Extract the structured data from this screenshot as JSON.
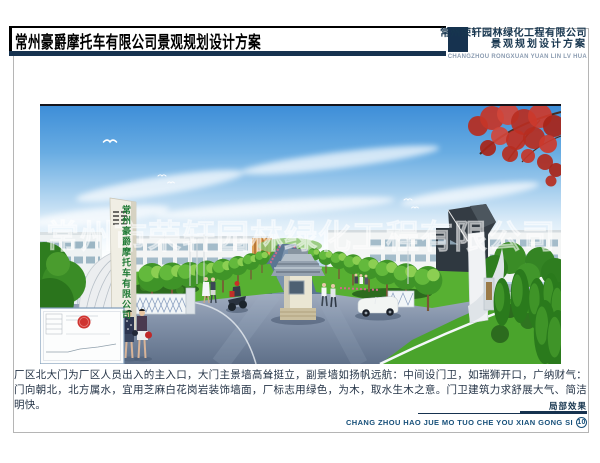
{
  "header": {
    "title": "常州豪爵摩托车有限公司景观规划设计方案",
    "company_name": "常州荣轩园林绿化工程有限公司",
    "company_subtitle": "景观规划设计方案",
    "company_pinyin": "CHANGZHOU RONGXUAN YUAN LIN LV HUA"
  },
  "photo": {
    "watermark": "常州市荣轩园林绿化工程有限公司",
    "gate_sign_text": "常州豪爵摩托车有限公司"
  },
  "caption": {
    "text": "厂区北大门为厂区人员出入的主入口，大门主景墙高耸挺立，副景墙如扬帆远航：中间设门卫，如瑞狮开口，广纳财气：门向朝北，北方属水，宜用芝麻白花岗岩装饰墙面，厂标志用绿色，为木，取水生木之意。门卫建筑力求舒展大气、简洁明快。"
  },
  "footer": {
    "label": "局部效果",
    "pinyin": "CHANG ZHOU HAO JUE MO TUO CHE YOU XIAN GONG SI",
    "page_number": "10"
  },
  "colors": {
    "navy": "#16324f",
    "sign_green": "#1f7a34",
    "sky_blue": "#3e8ed8",
    "road_gray": "#5f7089",
    "grass_green": "#57b032",
    "maple_red": "#c03028",
    "seal_red": "#cf3430"
  }
}
